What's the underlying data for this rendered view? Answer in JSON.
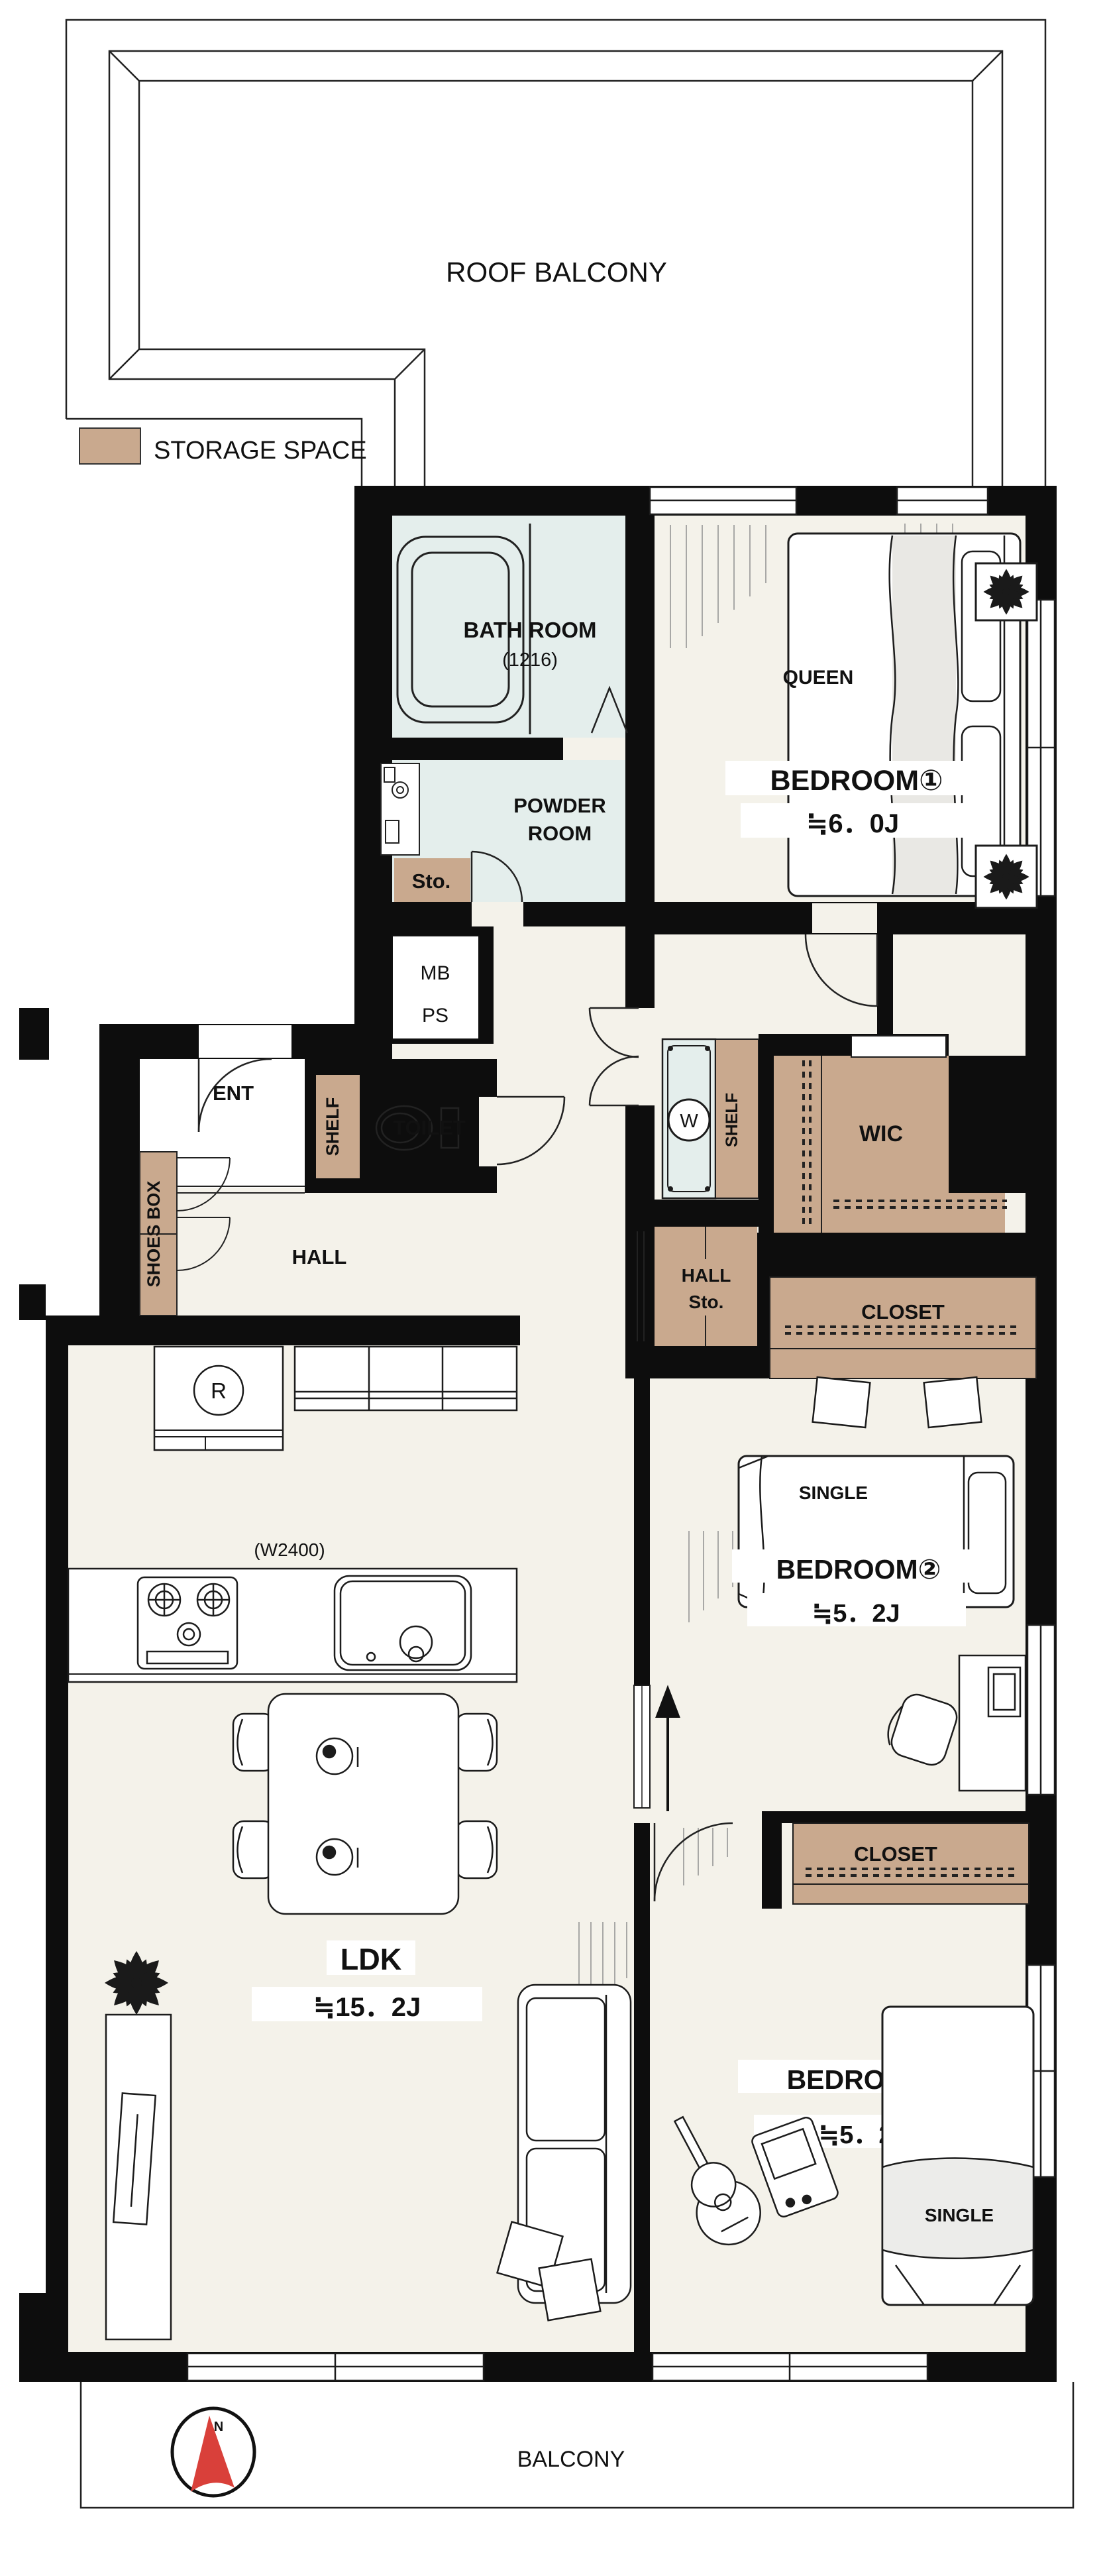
{
  "colors": {
    "storage_tan": "#c9a98e",
    "wet_area_blue": "#e4eeec",
    "floor_cream": "#f4f2ea",
    "wall_black": "#0d0d0d",
    "compass_red": "#d9403a"
  },
  "legend": {
    "storage_label": "STORAGE SPACE"
  },
  "rooms": {
    "roof_balcony": "ROOF BALCONY",
    "bath_room": "BATH ROOM",
    "bath_size": "(1216)",
    "powder_line1": "POWDER",
    "powder_line2": "ROOM",
    "storage_abbr": "Sto.",
    "meter_box": "MB",
    "pipe_space": "PS",
    "bedroom1": "BEDROOM①",
    "bedroom1_size": "≒6．0J",
    "bedroom1_bed": "QUEEN",
    "toilet": "TOILET",
    "toilet_shelf": "SHELF",
    "entrance": "ENT",
    "shoes_box": "SHOES BOX",
    "hall": "HALL",
    "washer": "W",
    "washer_shelf": "SHELF",
    "wic": "WIC",
    "hall_storage_line1": "HALL",
    "hall_storage_line2": "Sto.",
    "closet1": "CLOSET",
    "closet2": "CLOSET",
    "bedroom2": "BEDROOM②",
    "bedroom2_size": "≒5．2J",
    "bedroom2_bed": "SINGLE",
    "bedroom3": "BEDROOM③",
    "bedroom3_size": "≒5．2J",
    "bedroom3_bed": "SINGLE",
    "ldk": "LDK",
    "ldk_size": "≒15．2J",
    "kitchen_width": "(W2400)",
    "refrigerator": "R",
    "balcony": "BALCONY"
  },
  "compass": {
    "north_label": "N"
  }
}
